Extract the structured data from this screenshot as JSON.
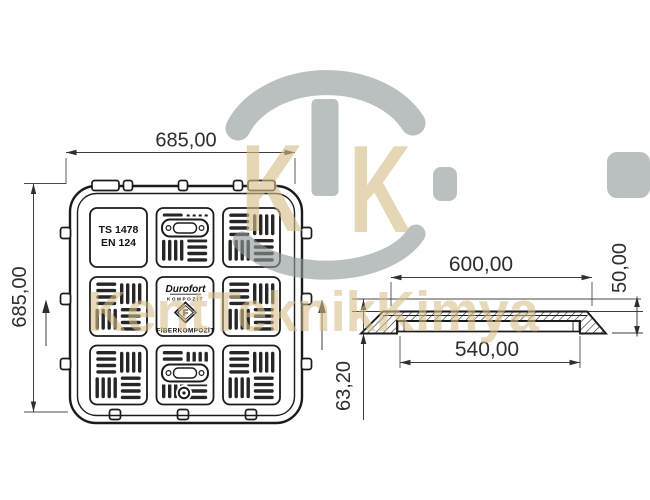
{
  "drawing": {
    "plan": {
      "dim_width": "685,00",
      "dim_height": "685,00",
      "std_line1": "TS 1478",
      "std_line2": "EN 124",
      "logo_name": "Durofort",
      "logo_sub": "KOMPOZİT",
      "logo_letter": "F",
      "logo_caption": "FİBERKOMPOZİT"
    },
    "section": {
      "dim_outer": "600,00",
      "dim_inner": "540,00",
      "dim_height": "50,00",
      "dim_depth": "63,20"
    }
  },
  "watermark": {
    "letter_left": "K",
    "letter_right": "K",
    "wordmark": "KentTeknikKimya"
  },
  "colors": {
    "line": "#1b1b1b",
    "bar": "#262626",
    "watermark_gray": "#8f979a",
    "watermark_beige": "#d6bf8a"
  }
}
